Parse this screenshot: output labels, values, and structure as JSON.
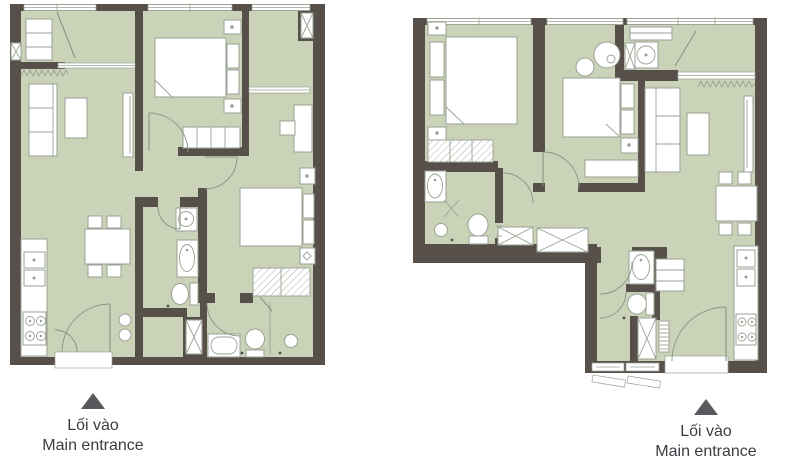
{
  "image": {
    "type": "architectural-floor-plans",
    "plan_count": 2
  },
  "colors": {
    "background": "#ffffff",
    "wall": "#57504a",
    "floor": "#cad2b7",
    "furniture_fill": "#ffffff",
    "furniture_outline": "#9aa294",
    "door_line": "#8a9486",
    "hatch_line": "#a9afa0",
    "window_line": "#9aa294",
    "entrance_marker": "#58595c",
    "label_text": "#3a3d41"
  },
  "plans": [
    {
      "id": "left-apartment",
      "entrance": {
        "marker_icon": "up-triangle-icon",
        "label_vi": "Lối vào",
        "label_en": "Main entrance"
      }
    },
    {
      "id": "right-apartment",
      "entrance": {
        "marker_icon": "up-triangle-icon",
        "label_vi": "Lối vào",
        "label_en": "Main entrance"
      }
    }
  ]
}
